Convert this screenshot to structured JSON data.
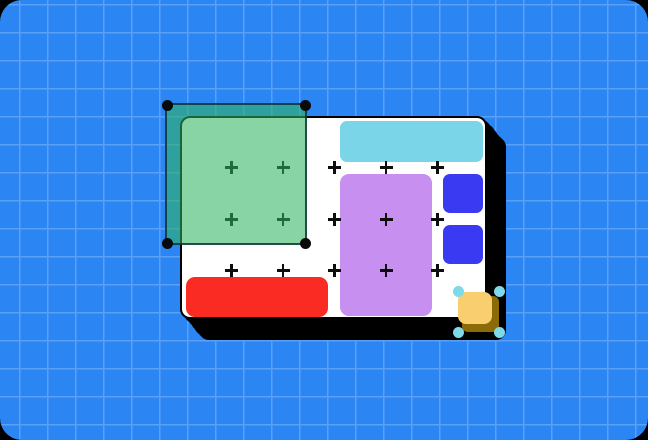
{
  "illustration": {
    "description": "design-canvas-illustration",
    "canvas": {
      "width": 648,
      "height": 440,
      "background_color": "#2B86F4",
      "grid_line_color": "#5BA0F7",
      "grid_size": 28,
      "grid_offset_x": 19,
      "grid_offset_y": 4,
      "corner_radius": 22,
      "outer_color": "#000000"
    },
    "card": {
      "x": 180,
      "y": 116,
      "w": 307,
      "h": 203,
      "r": 10,
      "fill": "#FFFFFF",
      "border_color": "#000000",
      "border_width": 2,
      "shadow_color": "#000000",
      "shadow_steps": [
        [
          4,
          4
        ],
        [
          8,
          8
        ],
        [
          11,
          12
        ],
        [
          14,
          16
        ],
        [
          17,
          19
        ],
        [
          19,
          21
        ]
      ]
    },
    "card_shapes": [
      {
        "name": "cyan-bar",
        "x": 340,
        "y": 121,
        "w": 143,
        "h": 41,
        "r": 7,
        "color": "#7BD5E8"
      },
      {
        "name": "purple-rect",
        "x": 340,
        "y": 174,
        "w": 92,
        "h": 142,
        "r": 9,
        "color": "#C78FF0"
      },
      {
        "name": "blue-square-top",
        "x": 443,
        "y": 174,
        "w": 40,
        "h": 39,
        "r": 7,
        "color": "#3B3AF3"
      },
      {
        "name": "blue-square-bottom",
        "x": 443,
        "y": 225,
        "w": 40,
        "h": 39,
        "r": 7,
        "color": "#3B3AF3"
      },
      {
        "name": "red-bar",
        "x": 186,
        "y": 277,
        "w": 142,
        "h": 40,
        "r": 9,
        "color": "#FA2B22"
      }
    ],
    "plus_markers": {
      "color": "#0d0d0d",
      "cols": [
        231.5,
        283,
        334.5,
        386,
        437.5
      ],
      "rows": [
        167.5,
        219.5,
        270.5
      ]
    },
    "green_selection": {
      "x": 165,
      "y": 103,
      "w": 142,
      "h": 142,
      "fill": "rgba(47,180,95,0.57)",
      "outline_color": "rgba(13,42,48,0.8)",
      "outline_width": 2,
      "handle_color": "#0A0A0A",
      "handle_diameter": 11
    },
    "yellow_selection_group": {
      "bounds": {
        "x": 458,
        "y": 291,
        "w": 41,
        "h": 41
      },
      "shadow_square": {
        "dx": 4,
        "dy": 5,
        "w": 37,
        "h": 36,
        "r": 6,
        "color": "#8B6B07"
      },
      "front_square": {
        "dx": 0,
        "dy": 1,
        "w": 34,
        "h": 32,
        "r": 8,
        "color": "#F9CE6E"
      },
      "handle_color": "#7ED9EA",
      "handle_diameter": 11
    }
  }
}
